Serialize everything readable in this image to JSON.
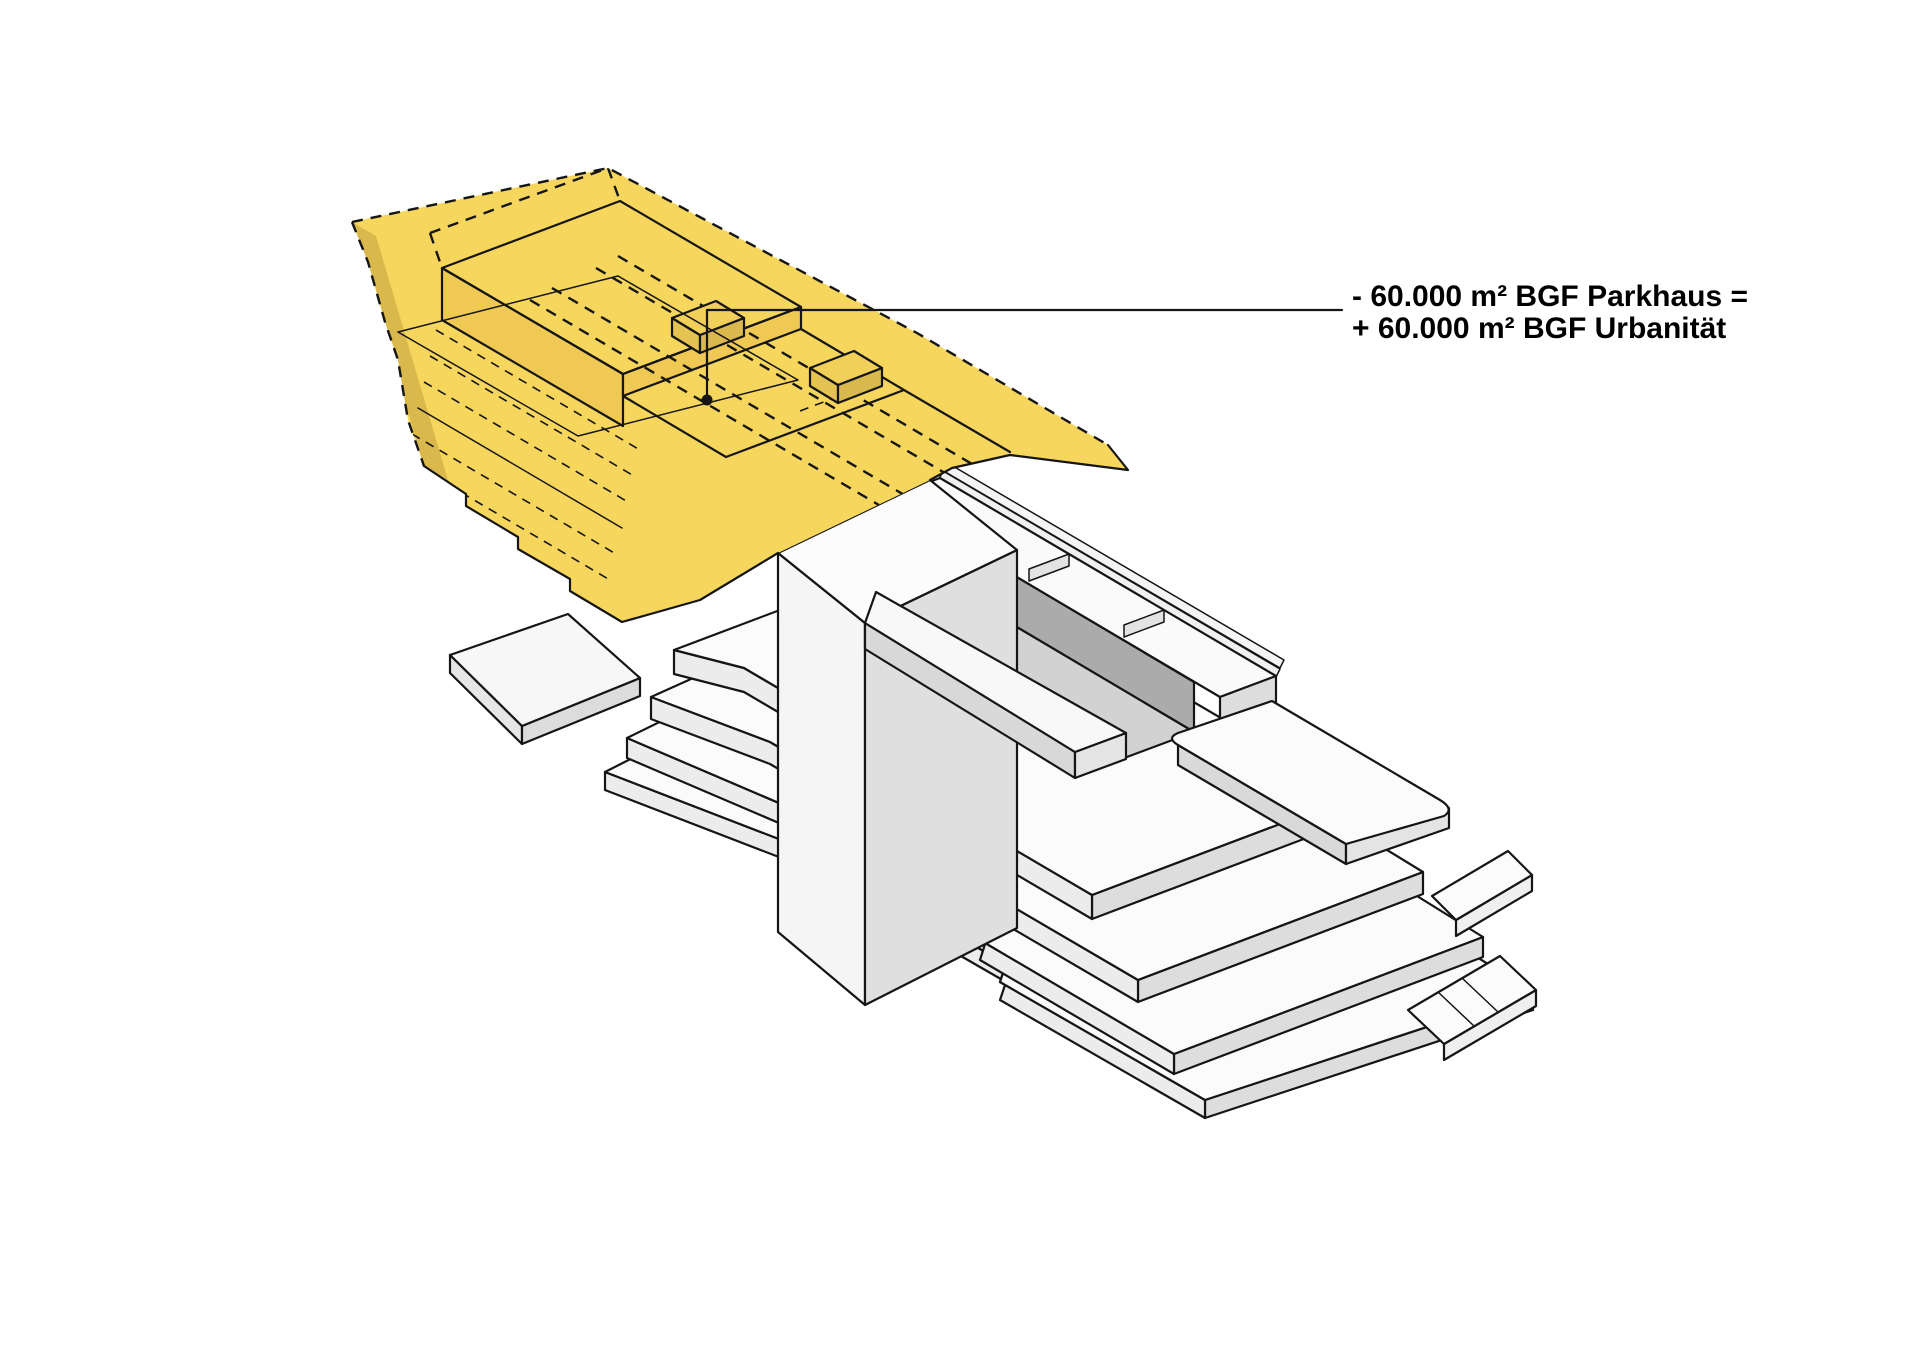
{
  "annotation": {
    "line1": "- 60.000 m² BGF Parkhaus =",
    "line2": "+ 60.000 m² BGF Urbanität"
  },
  "colors": {
    "background": "#FFFFFF",
    "highlight_yellow_top": "#F7D65E",
    "highlight_yellow_side": "#EFC954",
    "highlight_yellow_dark": "#D9B84C",
    "white_roof": "#FBFBFB",
    "gray_side_light": "#EFEFEF",
    "gray_side_mid": "#DDDDDD",
    "gray_fascia": "#D8D8D8",
    "courtyard_wall_dark": "#ABABAB",
    "courtyard_floor": "#D2D2D2",
    "outline": "#151515",
    "text": "#000000"
  },
  "marker": {
    "type": "leader-dot"
  }
}
